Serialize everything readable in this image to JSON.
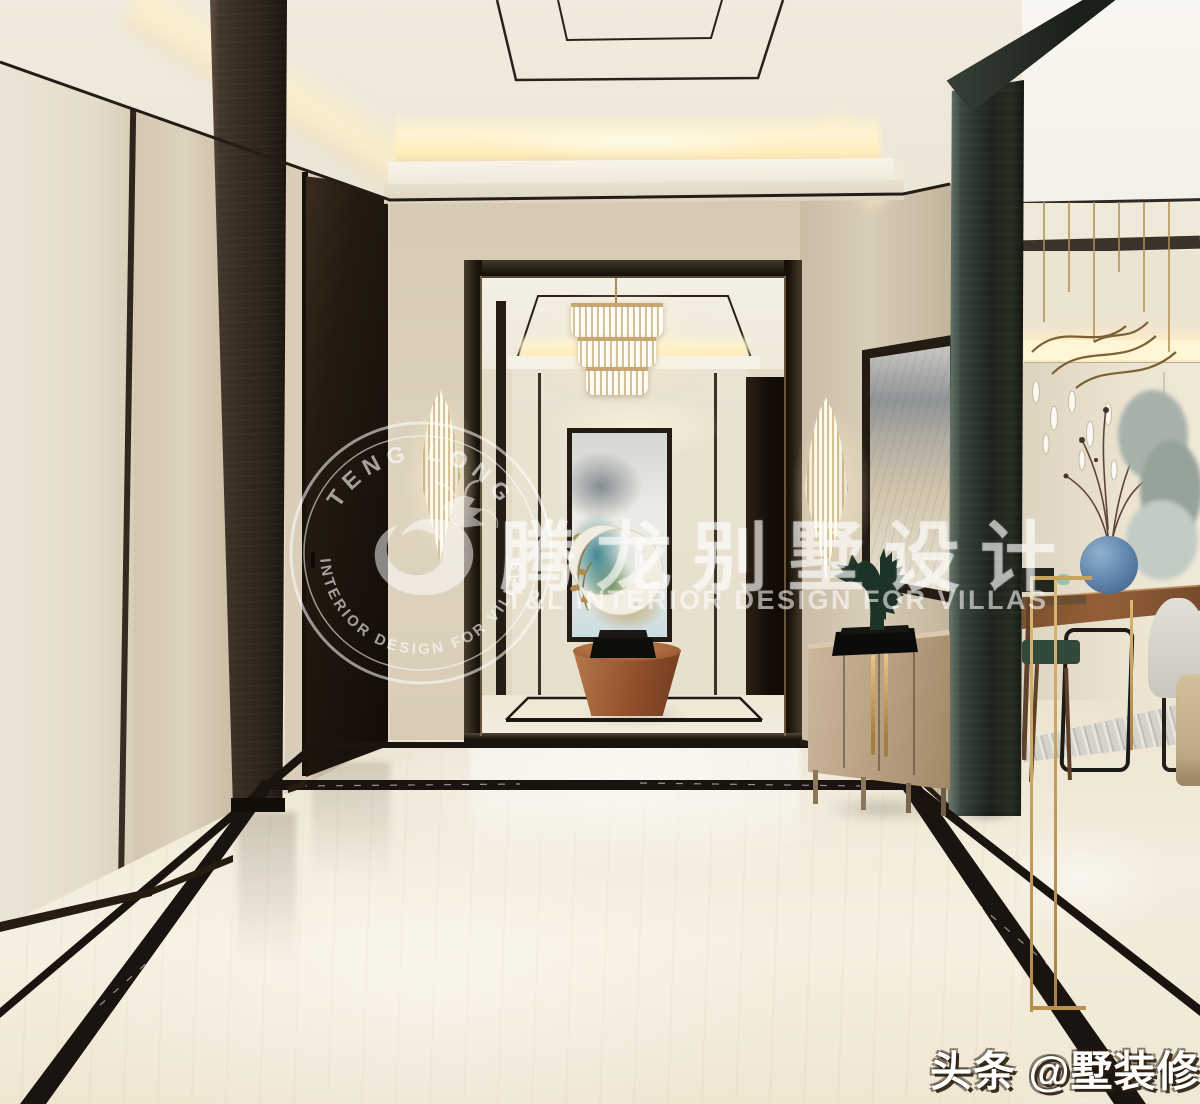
{
  "watermark": {
    "logo": {
      "top_text": "TENG LONG",
      "bottom_text": "· INTERIOR DESIGN FOR VILLAS ·"
    },
    "brand_cn": "腾龙别墅设计",
    "brand_en": "T&L  INTERIOR DESIGN FOR VILLAS"
  },
  "badge": {
    "text": "头条 @墅装修"
  },
  "colors": {
    "wall": "#ddd2be",
    "ceiling": "#f3efe4",
    "glow": "#fff3cf",
    "trim": "#241d15",
    "pillar": "#352a1f",
    "door": "#241a10",
    "floor": "#f3ecdb",
    "marble": "#1a1410",
    "gold": "#c2a066",
    "sideboard": "#bda684",
    "column": "#242e26",
    "wood": "#8a5733",
    "vase": "#5d81a8",
    "horse": "#1e3327",
    "rug": "#d5d2c9",
    "watermark": "#ffffff"
  }
}
